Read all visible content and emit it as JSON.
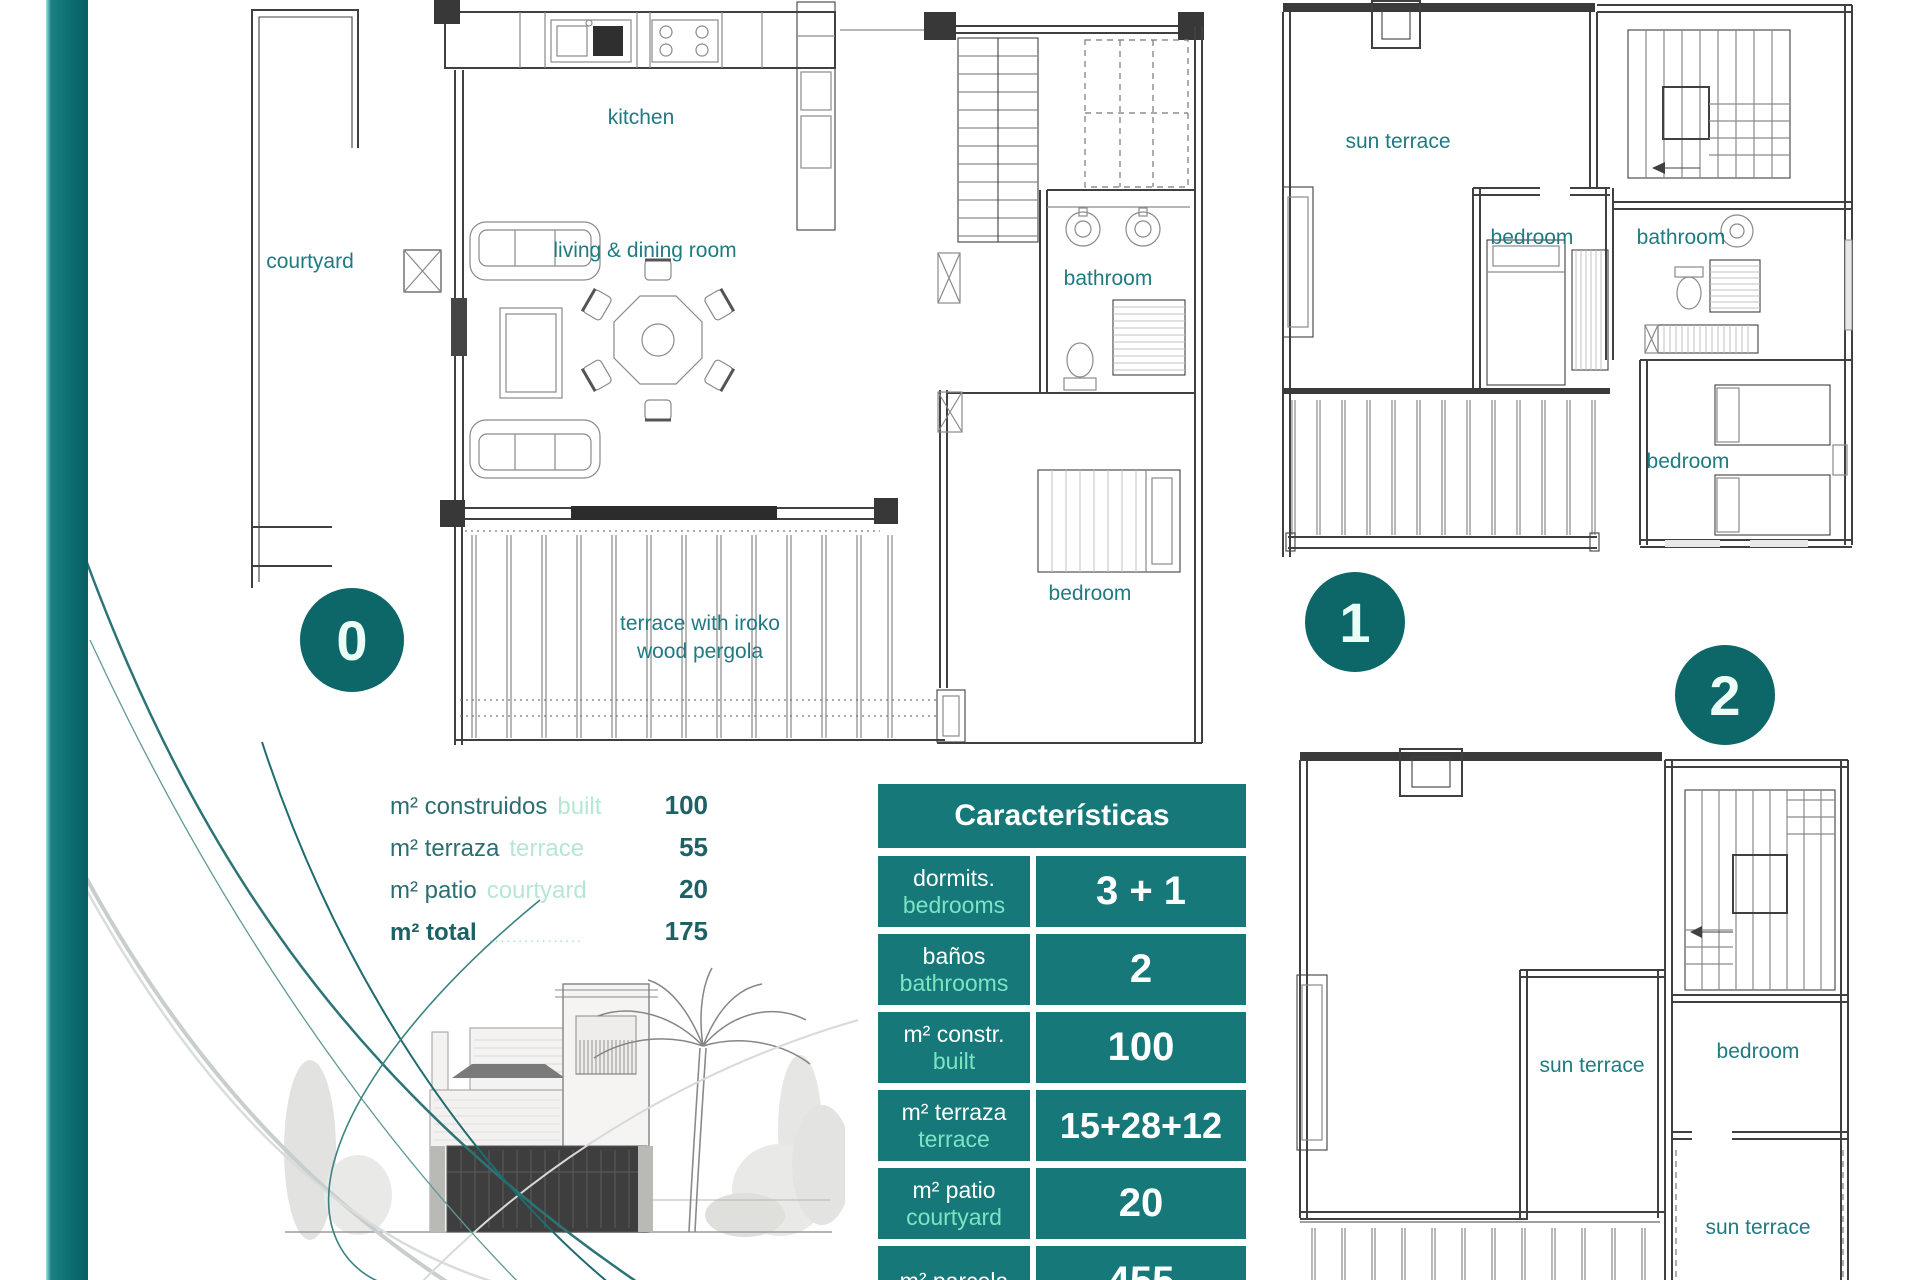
{
  "plans": {
    "floor0": {
      "badge": "0",
      "labels": {
        "kitchen": "kitchen",
        "courtyard": "courtyard",
        "living": "living & dining room",
        "bathroom": "bathroom",
        "bedroom": "bedroom",
        "terrace1": "terrace with iroko",
        "terrace2": "wood pergola"
      }
    },
    "floor1": {
      "badge": "1",
      "labels": {
        "sun_terrace": "sun terrace",
        "bedroom_top": "bedroom",
        "bathroom": "bathroom",
        "bedroom_right": "bedroom"
      }
    },
    "floor2": {
      "badge": "2",
      "labels": {
        "sun_terrace_mid": "sun terrace",
        "bedroom": "bedroom",
        "sun_terrace_bottom": "sun terrace"
      }
    }
  },
  "measurements": {
    "rows": [
      {
        "es": "m² construidos",
        "en": "built",
        "value": "100"
      },
      {
        "es": "m² terraza",
        "en": "terrace",
        "value": "55"
      },
      {
        "es": "m² patio",
        "en": "courtyard",
        "value": "20"
      }
    ],
    "total": {
      "es": "m² total",
      "leader": "................",
      "value": "175"
    }
  },
  "table": {
    "title": "Características",
    "rows": [
      {
        "es": "dormits.",
        "en": "bedrooms",
        "value": "3 + 1"
      },
      {
        "es": "baños",
        "en": "bathrooms",
        "value": "2"
      },
      {
        "es": "m² constr.",
        "en": "built",
        "value": "100"
      },
      {
        "es": "m² terraza",
        "en": "terrace",
        "value": "15+28+12"
      },
      {
        "es": "m² patio",
        "en": "courtyard",
        "value": "20"
      },
      {
        "es": "m² parcela",
        "en": "",
        "value": "455"
      }
    ]
  },
  "colors": {
    "accent_teal": "#0e6e71",
    "table_teal": "#17787a",
    "label_teal": "#1f7b81",
    "mint": "#7de4c3"
  }
}
